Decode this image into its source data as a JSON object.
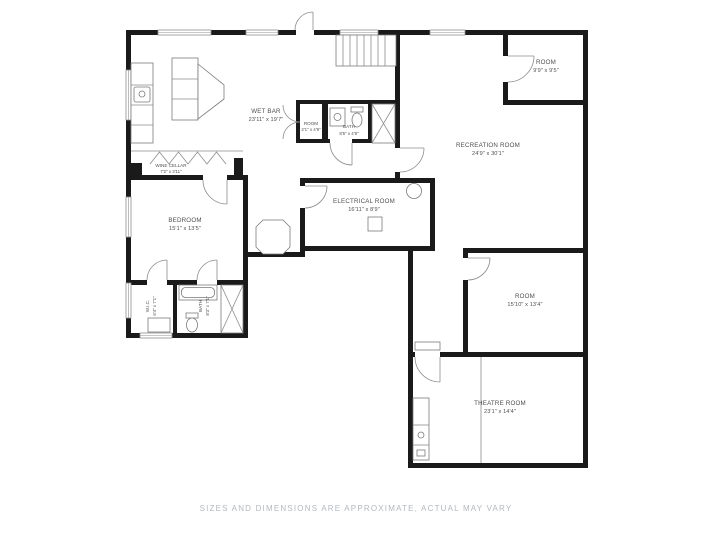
{
  "palette": {
    "background": "#ffffff",
    "wall": "#1a1a1a",
    "thin_line": "#8c8c8c",
    "label_text": "#4f4f4f",
    "footer_text": "#b3b9be"
  },
  "rooms": {
    "wet_bar": {
      "name": "WET BAR",
      "dims": "23'11\" x 19'7\""
    },
    "closet_room": {
      "name": "ROOM",
      "dims": "2'1\" x 4'9\""
    },
    "bath_upper": {
      "name": "BATH",
      "dims": "8'5\" x 4'9\""
    },
    "wine_cellar": {
      "name": "WINE CELLAR",
      "dims": "7'2\" x 3'11\""
    },
    "bedroom": {
      "name": "BEDROOM",
      "dims": "15'1\" x 13'5\""
    },
    "electrical": {
      "name": "ELECTRICAL ROOM",
      "dims": "16'11\" x 8'9\""
    },
    "recreation": {
      "name": "RECREATION ROOM",
      "dims": "24'9\" x 30'1\""
    },
    "room_top_right": {
      "name": "ROOM",
      "dims": "9'9\" x 9'5\""
    },
    "room_mid_right": {
      "name": "ROOM",
      "dims": "15'10\" x 13'4\""
    },
    "theatre": {
      "name": "THEATRE ROOM",
      "dims": "23'1\" x 14'4\""
    },
    "wic": {
      "name": "W.I.C.",
      "dims": "6'4\" x 7'1\""
    },
    "bath_lower": {
      "name": "BATH",
      "dims": "8'3\" x 7'1\""
    }
  },
  "footer": {
    "text": "SIZES AND DIMENSIONS ARE APPROXIMATE, ACTUAL MAY VARY"
  }
}
